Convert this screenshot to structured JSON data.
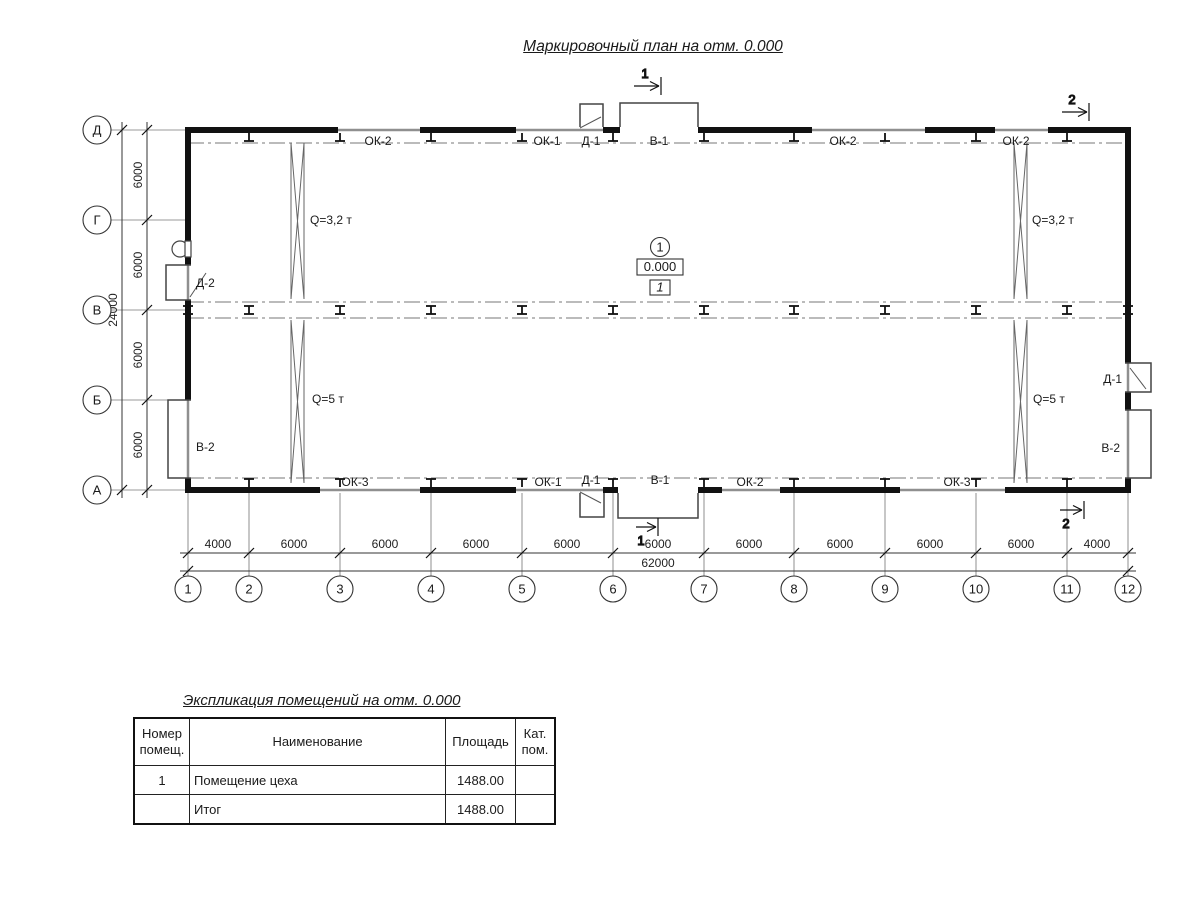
{
  "title": "Маркировочный план на отм. 0.000",
  "plan": {
    "row_axes": [
      "Д",
      "Г",
      "В",
      "Б",
      "А"
    ],
    "col_axes": [
      "1",
      "2",
      "3",
      "4",
      "5",
      "6",
      "7",
      "8",
      "9",
      "10",
      "11",
      "12"
    ],
    "dims_bottom": [
      "4000",
      "6000",
      "6000",
      "6000",
      "6000",
      "6000",
      "6000",
      "6000",
      "6000",
      "6000",
      "4000"
    ],
    "dim_bottom_total": "62000",
    "dims_left": [
      "6000",
      "6000",
      "6000",
      "6000"
    ],
    "dim_left_total": "24000",
    "top_labels": [
      "ОК-2",
      "ОК-1",
      "Д-1",
      "В-1",
      "ОК-2",
      "ОК-2"
    ],
    "bottom_labels": [
      "ОК-3",
      "ОК-1",
      "Д-1",
      "В-1",
      "ОК-2",
      "ОК-3"
    ],
    "left_labels": [
      "Д-2",
      "В-2"
    ],
    "right_labels": [
      "Д-1",
      "В-2"
    ],
    "crane_labels": [
      "Q=3,2 т",
      "Q=5 т",
      "Q=3,2 т",
      "Q=5 т"
    ],
    "room_marker": {
      "number": "1",
      "elevation": "0.000",
      "room_tag": "1"
    },
    "section_marks": {
      "top_center": "1",
      "top_right": "2",
      "bottom_center": "1",
      "bottom_right": "2"
    }
  },
  "table": {
    "title": "Экспликация помещений на отм. 0.000",
    "headers": [
      "Номер помещ.",
      "Наименование",
      "Площадь",
      "Кат. пом."
    ],
    "rows": [
      {
        "num": "1",
        "name": "Помещение цеха",
        "area": "1488.00",
        "cat": ""
      },
      {
        "num": "",
        "name": "Итог",
        "area": "1488.00",
        "cat": ""
      }
    ]
  }
}
